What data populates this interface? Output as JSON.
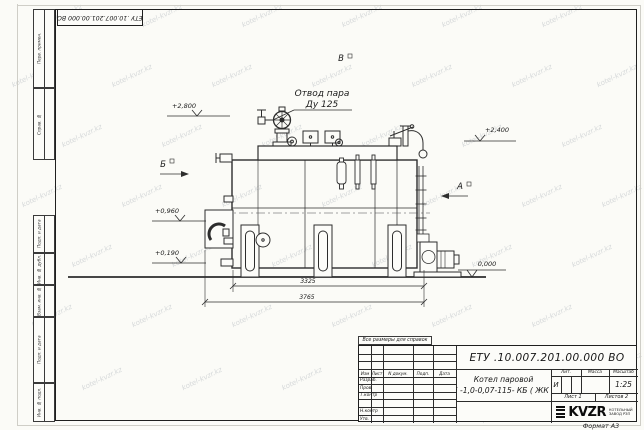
{
  "watermark": {
    "text": "kotel-kvzr.kz"
  },
  "frame": {
    "top_stamp": "ЕТУ .10.007.201.00.000  ВО",
    "margin_labels": {
      "perv_primen": "Перв. примен.",
      "sprav_no": "Справ. №",
      "podp_data_1": "Подп. и дата",
      "inv_dubl": "Инв. № дубл.",
      "vzam_inv": "Взам. инв. №",
      "podp_data_2": "Подп. и дата",
      "inv_podl": "Инв. № подл."
    }
  },
  "drawing": {
    "callout_line1": "Отвод пара",
    "callout_line2": "Ду 125",
    "elev_2800": "+2,800",
    "elev_2400": "+2,400",
    "elev_0960": "+0,960",
    "elev_0190": "+0,190",
    "elev_0000": "0,000",
    "view_a": "А",
    "view_b": "Б",
    "view_v": "В",
    "dim_3325": "3325",
    "dim_3765": "3765"
  },
  "title_block": {
    "note": "Все размеры для справок",
    "designation": "ЕТУ .10.007.201.00.000  ВО",
    "name_line1": "Котел паровой",
    "name_line2": "Е -1,0-0,07-115- КБ ( ЖК )",
    "col_izm": "Изм",
    "col_list": "Лист",
    "col_ndoc": "N докум.",
    "col_podp": "Подп.",
    "col_data": "Дата",
    "row_razrab": "Разраб.",
    "row_prov": "Пров.",
    "row_tkontr": "Т.контр",
    "row_nkontr": "Н.контр",
    "row_utv": "Утв.",
    "lit_header": "Лит.",
    "mass_header": "Масса",
    "scale_header": "Масштаб",
    "lit_value": "И",
    "scale_value": "1:25",
    "sheet_text": "Лист 1",
    "sheets_text": "Листов 2",
    "logo_text": "KVZR",
    "logo_caption1": "КОТЕЛЬНЫЙ",
    "logo_caption2": "ЗАВОД РЗП",
    "format_text": "Формат А3"
  }
}
